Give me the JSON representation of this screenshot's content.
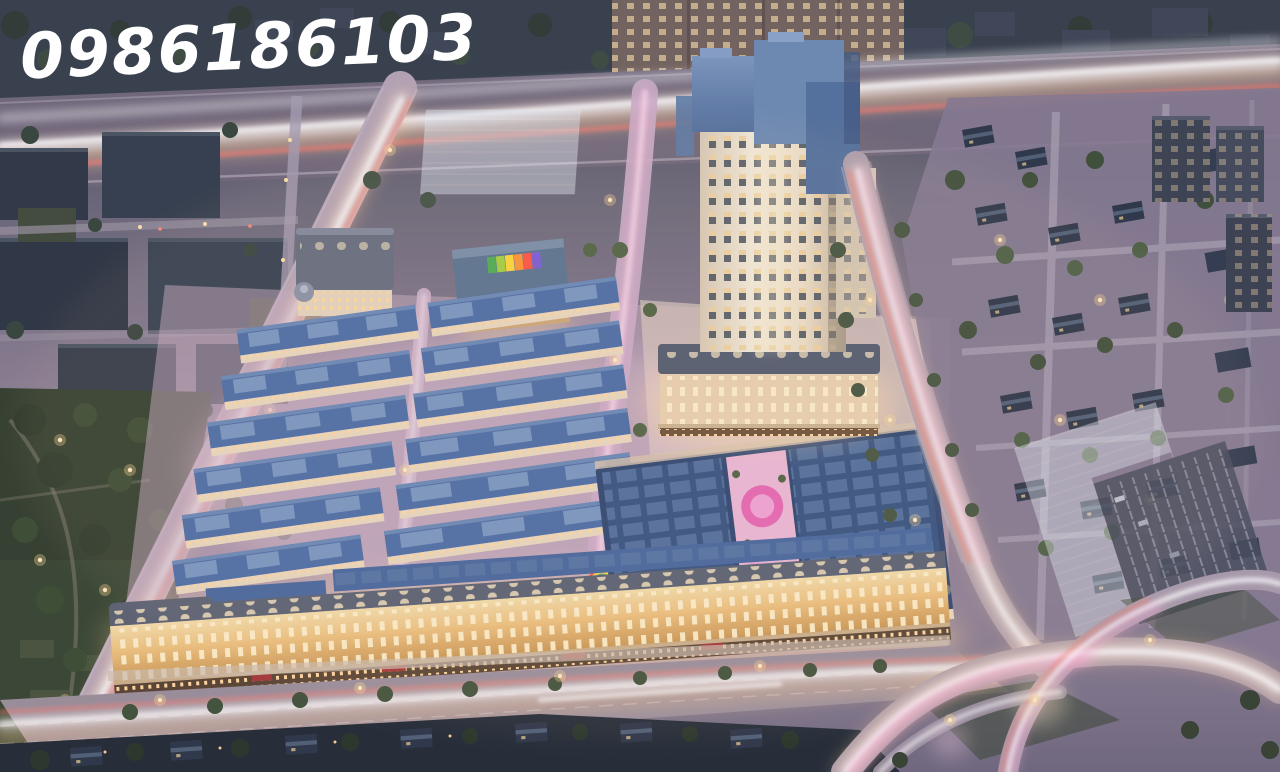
{
  "watermark": {
    "text": "0986186103",
    "color": "#ffffff"
  },
  "scene": {
    "type": "aerial-dusk-architectural-render",
    "palette": {
      "dusk_top": "#38414f",
      "ground_mauve": "#857b90",
      "park_green": "#313e2c",
      "tree_green": "#3c4e36",
      "roof_blue": "#4a6da5",
      "roof_navy": "#2c466f",
      "roof_slate": "#596070",
      "facade_cream": "#e8d9c2",
      "facade_gold": "#eec27c",
      "window_warm": "#ffd98e",
      "storefront_dark": "#58422f",
      "asphalt": "#6d6678",
      "road_light": "#b5a6b6",
      "trail_white": "#ffffff",
      "trail_warm": "#ffcf9a",
      "trail_pink": "#ffa9d4",
      "trail_red": "#ff7a6a",
      "pool_pink": "#e867b4",
      "courtyard_pink": "#ecb9d6",
      "ghost_glass": "#dfe9f2"
    },
    "rainbow_arch_colors": [
      "#4caf50",
      "#a6d23a",
      "#ffd835",
      "#ff9432",
      "#ff5340",
      "#7a5cd6"
    ]
  }
}
